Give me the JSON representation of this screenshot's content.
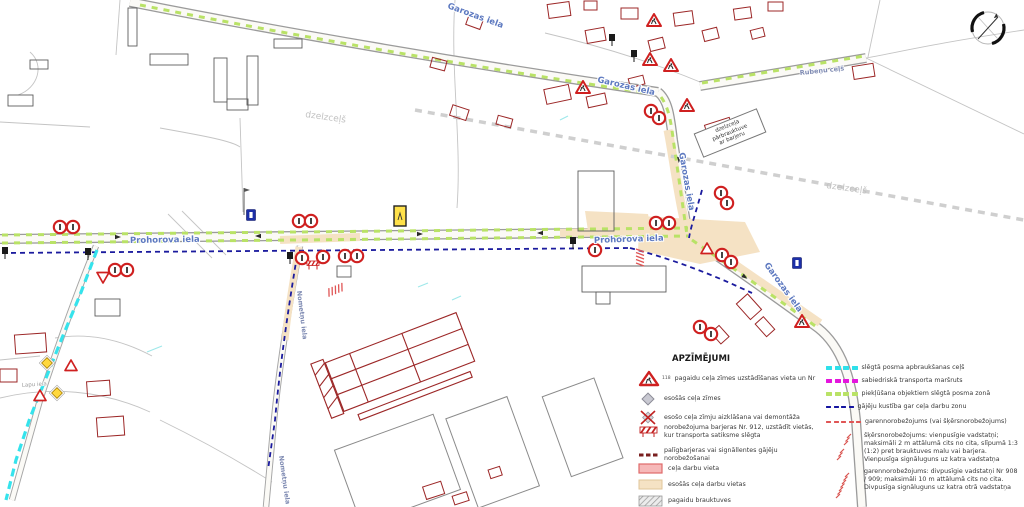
{
  "map": {
    "street_labels": [
      {
        "text": "Prohorova iela"
      },
      {
        "text": "Prohorova iela"
      },
      {
        "text": "Garozas iela"
      },
      {
        "text": "Garozas iela"
      },
      {
        "text": "Garozas iela"
      },
      {
        "text": "Garozas iela"
      },
      {
        "text": "Rubeņu ceļš"
      },
      {
        "text": "Nometņu iela"
      },
      {
        "text": "Nometņu iela"
      },
      {
        "text": "Lapu iela"
      }
    ],
    "railway_labels": [
      {
        "text": "dzelzceļš"
      },
      {
        "text": "dzelzceļš"
      }
    ],
    "note_box": {
      "lines": [
        "dzelzceļa",
        "pārbrauktuve",
        "ar barjeru"
      ]
    },
    "markers": [
      {
        "t": "noentry",
        "x": 60,
        "y": 227
      },
      {
        "t": "noentry",
        "x": 73,
        "y": 227
      },
      {
        "t": "blacksign",
        "x": 5,
        "y": 253
      },
      {
        "t": "blacksign",
        "x": 88,
        "y": 254
      },
      {
        "t": "noentry",
        "x": 115,
        "y": 270
      },
      {
        "t": "noentry",
        "x": 127,
        "y": 270
      },
      {
        "t": "yieldtri",
        "x": 103,
        "y": 277
      },
      {
        "t": "noentry",
        "x": 299,
        "y": 221
      },
      {
        "t": "noentry",
        "x": 311,
        "y": 221
      },
      {
        "t": "bluesq",
        "x": 251,
        "y": 215
      },
      {
        "t": "blacksign",
        "x": 290,
        "y": 258
      },
      {
        "t": "noentry",
        "x": 302,
        "y": 258
      },
      {
        "t": "barrier",
        "x": 313,
        "y": 264
      },
      {
        "t": "noentry",
        "x": 323,
        "y": 257
      },
      {
        "t": "noentry",
        "x": 345,
        "y": 256
      },
      {
        "t": "noentry",
        "x": 357,
        "y": 256
      },
      {
        "t": "redhatch",
        "x": 335,
        "y": 290,
        "r": -22
      },
      {
        "t": "yellowrect",
        "x": 400,
        "y": 216
      },
      {
        "t": "blacksign",
        "x": 573,
        "y": 243
      },
      {
        "t": "noentry",
        "x": 595,
        "y": 250
      },
      {
        "t": "redhatch",
        "x": 640,
        "y": 257,
        "r": 90
      },
      {
        "t": "noentry",
        "x": 656,
        "y": 223
      },
      {
        "t": "noentry",
        "x": 669,
        "y": 223
      },
      {
        "t": "plaintri",
        "x": 707,
        "y": 249
      },
      {
        "t": "noentry",
        "x": 722,
        "y": 255
      },
      {
        "t": "noentry",
        "x": 731,
        "y": 262
      },
      {
        "t": "bluesq",
        "x": 797,
        "y": 263
      },
      {
        "t": "noentry",
        "x": 721,
        "y": 193
      },
      {
        "t": "noentry",
        "x": 727,
        "y": 203
      },
      {
        "t": "worktri",
        "x": 583,
        "y": 88
      },
      {
        "t": "blacksign",
        "x": 612,
        "y": 40
      },
      {
        "t": "blacksign",
        "x": 634,
        "y": 56
      },
      {
        "t": "worktri",
        "x": 650,
        "y": 60
      },
      {
        "t": "worktri",
        "x": 654,
        "y": 21
      },
      {
        "t": "worktri",
        "x": 671,
        "y": 66
      },
      {
        "t": "worktri",
        "x": 687,
        "y": 106
      },
      {
        "t": "noentry",
        "x": 651,
        "y": 111
      },
      {
        "t": "noentry",
        "x": 659,
        "y": 118
      },
      {
        "t": "worktri",
        "x": 802,
        "y": 322
      },
      {
        "t": "noentry",
        "x": 700,
        "y": 327
      },
      {
        "t": "noentry",
        "x": 711,
        "y": 334
      },
      {
        "t": "yellowdiamond",
        "x": 47,
        "y": 363
      },
      {
        "t": "yellowdiamond",
        "x": 57,
        "y": 393
      },
      {
        "t": "plaintri",
        "x": 71,
        "y": 366
      },
      {
        "t": "plaintri",
        "x": 40,
        "y": 396
      },
      {
        "t": "arrow",
        "x": 118,
        "y": 237
      },
      {
        "t": "arrow",
        "x": 258,
        "y": 236,
        "r": 180
      },
      {
        "t": "arrow",
        "x": 420,
        "y": 234
      },
      {
        "t": "arrow",
        "x": 540,
        "y": 233,
        "r": 180
      },
      {
        "t": "arrow",
        "x": 679,
        "y": 160,
        "r": 95
      },
      {
        "t": "arrow",
        "x": 745,
        "y": 277,
        "r": 35
      }
    ]
  },
  "legend": {
    "title": "APZĪMĒJUMI",
    "left_items": [
      {
        "icon": "worktri-icon",
        "badge": "118",
        "label": "pagaidu ceļa zīmes uzstādīšanas vieta un Nr"
      },
      {
        "icon": "gray-diamond-icon",
        "label": "esošās ceļa zīmes"
      },
      {
        "icon": "crossed-sign-icon",
        "label": "esošo ceļa zīmju aizklāšana vai demontāža"
      },
      {
        "icon": "barrier-icon",
        "label": "norobežojuma barjeras Nr. 912, uzstādīt vietās, kur transporta satiksme slēgta"
      },
      {
        "icon": "mini-dashes-icon",
        "label": "palīgbarjeras vai signāllentes gājēju norobežošanai"
      },
      {
        "icon": "pink-area-swatch",
        "label": "ceļa darbu vieta"
      },
      {
        "icon": "tan-area-swatch",
        "label": "esošās ceļa darbu vietas"
      },
      {
        "icon": "hatch-area-swatch",
        "label": "pagaidu brauktuves"
      }
    ],
    "right_items": [
      {
        "swatch": "cyan",
        "label": "slēgtā posma apbraukšanas ceļš"
      },
      {
        "swatch": "magenta",
        "label": "sabiedriskā transporta maršruts"
      },
      {
        "swatch": "green",
        "label": "piekļūšana objektiem slēgtā posma zonā"
      },
      {
        "swatch": "navy",
        "label": "gājēju kustība gar ceļa darbu zonu"
      },
      {
        "swatch": "red-dash",
        "label": "garennorobežojums (vai šķērsnorobežojums)"
      },
      {
        "swatch": "red-hatch-1",
        "label": "šķērsnorobežojums: vienpusīgie vadstatņi; maksimāli 2 m attālumā cits no cita, slīpumā 1:3 (1:2) pret brauktuves malu vai barjera. Vienpusīga signāluguns uz katra vadstatņa"
      },
      {
        "swatch": "red-hatch-2",
        "label": "garennorobežojums: divpusīgie vadstatņi Nr 908 / 909; maksimāli 10 m attālumā cits no cita. Divpusīga signāluguns uz katra otrā vadstatņa"
      }
    ]
  },
  "colors": {
    "detour_cyan": "#2ee0ea",
    "transport_magenta": "#e415dd",
    "access_green": "#b9e266",
    "pedestrian_navy": "#1515a0",
    "barrier_red": "#e05555",
    "work_area_pink": "#f6b8b8",
    "existing_work_tan": "#f5e2c4",
    "building_red": "#9c2727",
    "sign_red": "#cf2020",
    "railway_gray": "#cfcfcf"
  }
}
